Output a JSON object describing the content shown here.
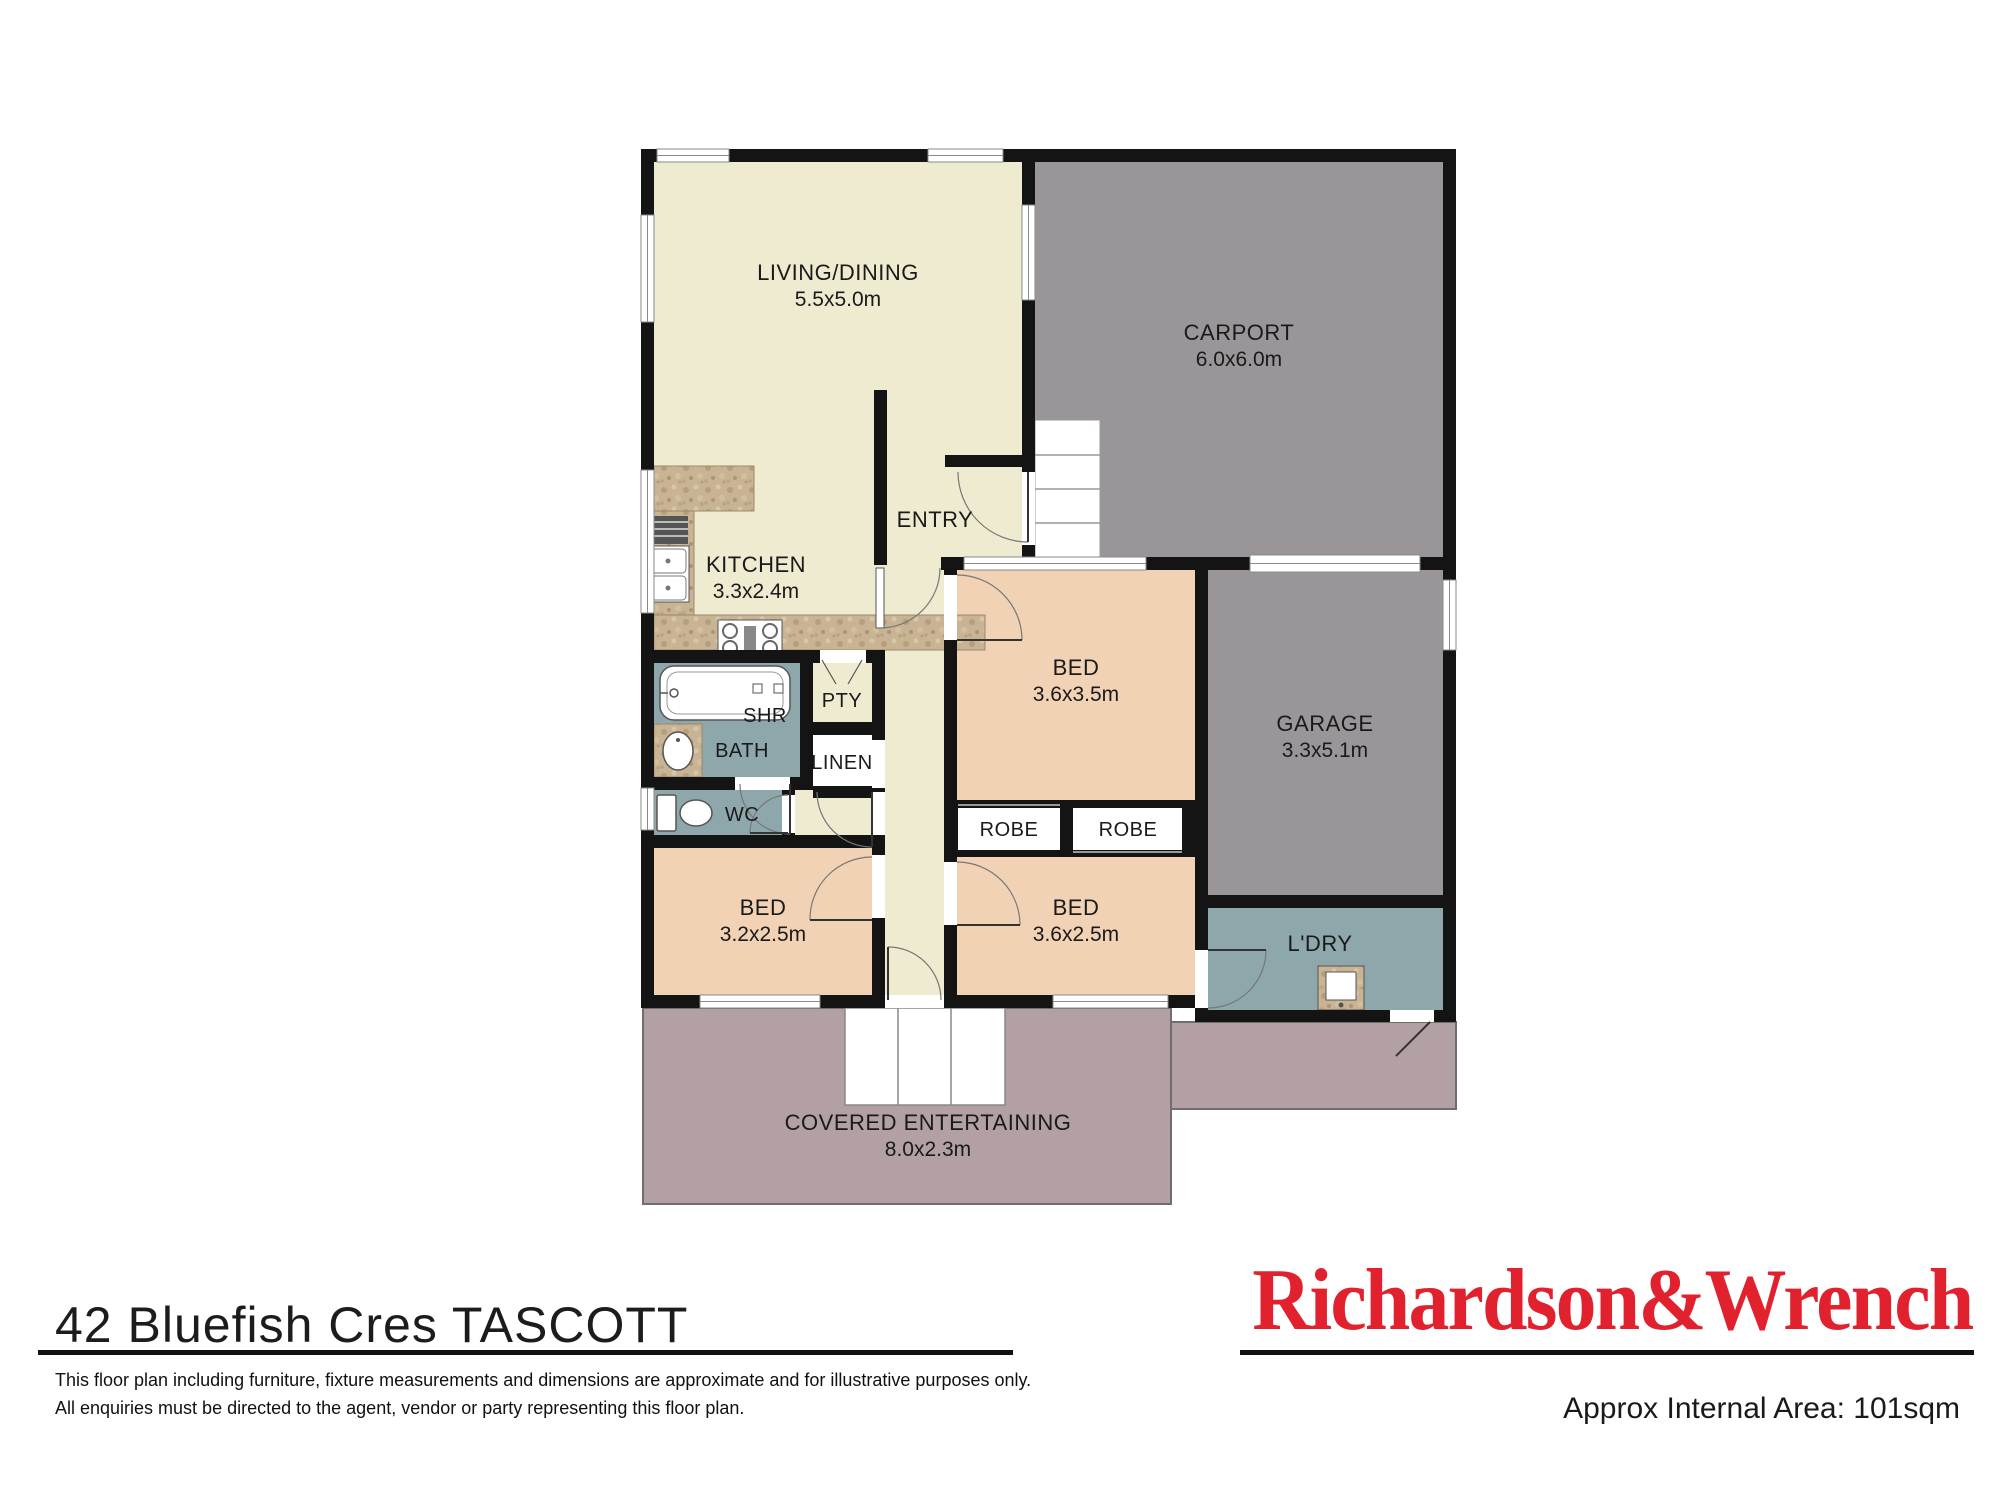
{
  "rooms": {
    "living": {
      "name": "LIVING/DINING",
      "dims": "5.5x5.0m"
    },
    "carport": {
      "name": "CARPORT",
      "dims": "6.0x6.0m"
    },
    "entry": {
      "name": "ENTRY"
    },
    "kitchen": {
      "name": "KITCHEN",
      "dims": "3.3x2.4m"
    },
    "bed1": {
      "name": "BED",
      "dims": "3.6x3.5m"
    },
    "garage": {
      "name": "GARAGE",
      "dims": "3.3x5.1m"
    },
    "shower": {
      "name": "SHR"
    },
    "bath": {
      "name": "BATH"
    },
    "pantry": {
      "name": "PTY"
    },
    "linen": {
      "name": "LINEN"
    },
    "wc": {
      "name": "WC"
    },
    "robe1": {
      "name": "ROBE"
    },
    "robe2": {
      "name": "ROBE"
    },
    "bed2": {
      "name": "BED",
      "dims": "3.2x2.5m"
    },
    "bed3": {
      "name": "BED",
      "dims": "3.6x2.5m"
    },
    "laundry": {
      "name": "L'DRY"
    },
    "covered": {
      "name": "COVERED ENTERTAINING",
      "dims": "8.0x2.3m"
    }
  },
  "footer": {
    "address": "42 Bluefish Cres TASCOTT",
    "disclaimer_line1": "This floor plan including furniture, fixture measurements and dimensions are approximate and for illustrative purposes only.",
    "disclaimer_line2": "All enquiries must be directed to the agent, vendor or party representing this floor plan.",
    "brand": "Richardson&Wrench",
    "area": "Approx Internal Area: 101sqm"
  },
  "colors": {
    "floor_cream": "#EFEBD0",
    "carport_gray": "#9A9598",
    "bedroom_peach": "#F1D2B4",
    "wet_area_teal": "#8EA7AB",
    "outdoor_mauve": "#B2A0A3",
    "counter_tan": "#C8B394",
    "wall_black": "#141414",
    "brand_red": "#E2212E"
  }
}
